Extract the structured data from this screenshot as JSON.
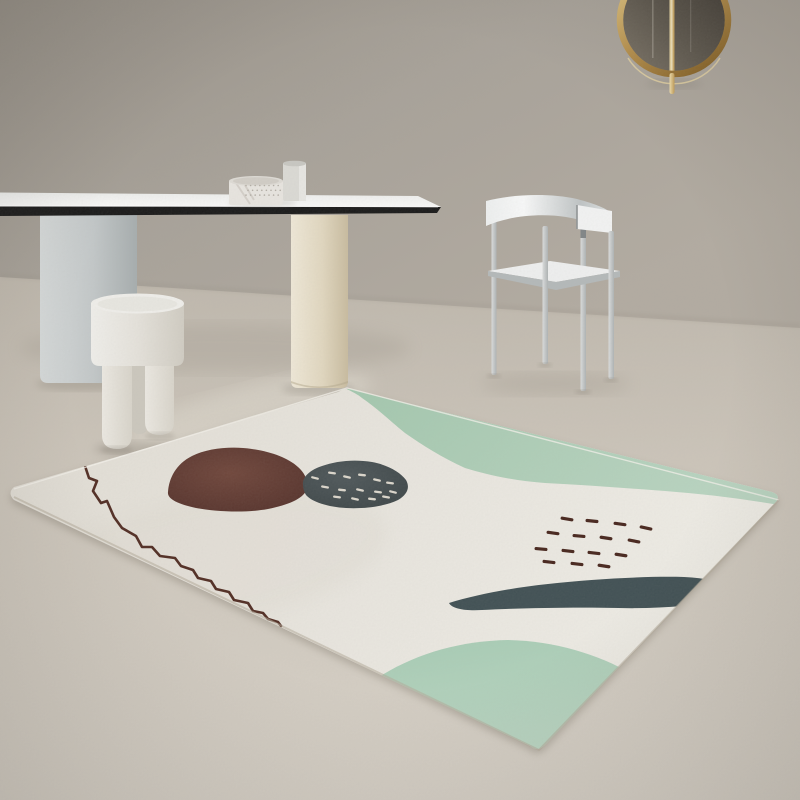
{
  "meta": {
    "type": "photograph",
    "subject": "minimalist interior with abstract ivory area rug, dining table, stool, white chair and round gold wall mirror"
  },
  "palette": {
    "wallMid": "#a8a299",
    "floorLight": "#d8d2c8",
    "rugBase": "#e9e6df",
    "greenTop": "#a9cbb2",
    "greenBottom": "#aecfb8",
    "blobBrown": "#5d352d",
    "blobGrey": "#3f4a4c",
    "tealStroke": "#3e4e52",
    "wavyLine": "#4f2a20",
    "dashBrown": "#45231a",
    "speckleWhite": "#ddd8cd",
    "tableTopWhite": "#f4f4f2",
    "tableEdgeBlack": "#161616",
    "legGrey": "#c3c8c9",
    "legCream": "#e2d8c0",
    "stoolWhite": "#e9e7e0",
    "chairWhite": "#eceded",
    "mirrorGold": "#b8914c",
    "mirrorGlass": "#55504a",
    "potDot": "#b3aea5"
  },
  "objects": {
    "mirror": {
      "shape": "round",
      "frame": "gold",
      "glass": "smoked",
      "detail": "thin gold rod through centre"
    },
    "table": {
      "top": "white slab",
      "edge": "black band",
      "leg_left": "grey cylinder",
      "leg_right": "cream cylinder"
    },
    "vases": {
      "left": "low marble cylinder pot",
      "right": "tall white cylinder vase"
    },
    "stool": {
      "style": "round-top white stool with three cylindrical legs"
    },
    "chair": {
      "style": "white metal chair with curved backrest band and thin legs"
    },
    "rug": {
      "style": "abstract scandinavian",
      "motifs": [
        "mint band along top edge",
        "mint mound in bottom corner",
        "maroon blob",
        "speckled charcoal blob",
        "dark teal brush stroke",
        "wavy maroon line",
        "scattered maroon dashes"
      ]
    }
  },
  "marks": {
    "brown_dashes": [
      [
        567,
        519,
        10
      ],
      [
        592,
        521,
        6
      ],
      [
        620,
        524,
        8
      ],
      [
        646,
        528,
        12
      ],
      [
        553,
        533,
        8
      ],
      [
        579,
        536,
        5
      ],
      [
        606,
        538,
        9
      ],
      [
        634,
        541,
        11
      ],
      [
        541,
        549,
        5
      ],
      [
        568,
        551,
        7
      ],
      [
        594,
        553,
        7
      ],
      [
        621,
        555,
        9
      ],
      [
        549,
        562,
        7
      ],
      [
        577,
        564,
        7
      ],
      [
        604,
        566,
        9
      ]
    ],
    "white_speckles": [
      [
        315,
        478,
        14
      ],
      [
        332,
        473,
        8
      ],
      [
        347,
        477,
        12
      ],
      [
        362,
        475,
        6
      ],
      [
        377,
        480,
        12
      ],
      [
        390,
        483,
        8
      ],
      [
        325,
        487,
        10
      ],
      [
        342,
        490,
        6
      ],
      [
        360,
        490,
        12
      ],
      [
        378,
        492,
        8
      ],
      [
        393,
        492,
        14
      ],
      [
        337,
        497,
        8
      ],
      [
        355,
        499,
        12
      ],
      [
        372,
        499,
        6
      ],
      [
        386,
        497,
        10
      ]
    ],
    "pot_dots": {
      "x0": 246,
      "y0": 185.5,
      "cols": 8,
      "rows": 3,
      "dx": 4.6,
      "dy": 4.8,
      "r": 0.8
    }
  }
}
